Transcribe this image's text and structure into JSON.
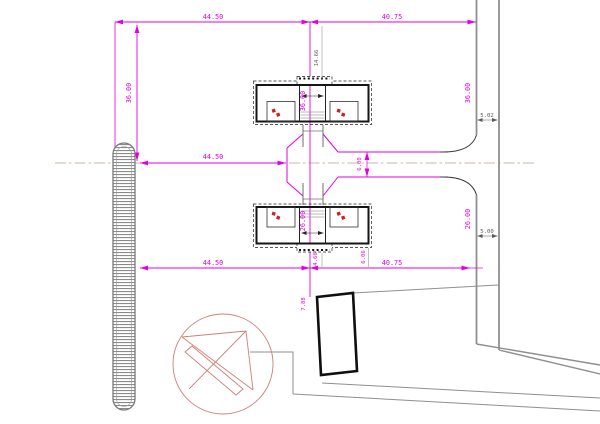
{
  "plan": {
    "dims": {
      "top_span_left": "44.50",
      "top_span_right": "40.75",
      "mid_span": "44.50",
      "bottom_span_left": "44.50",
      "bottom_span_right": "40.75",
      "left_depth": "36.00",
      "center_depth_upper": "36.00",
      "right_depth_upper": "36.00",
      "center_depth_lower": "26.00",
      "right_depth_lower": "26.00",
      "road_width": "6.00",
      "edge_offset_upper": "5.02",
      "edge_offset_lower": "5.00",
      "entry_depth": "14.66",
      "porch_offset_a": "4.66",
      "porch_offset_b": "6.06",
      "substation_offset": "7.88"
    },
    "colors": {
      "dimension_magenta": "#e100e1",
      "boundary_gray": "#8f8f8f",
      "wall_black": "#151515",
      "detail_red": "#cc2222",
      "symbol_salmon": "#cd8078",
      "centerline_tan": "#c4baa8",
      "background": "#ffffff"
    }
  }
}
